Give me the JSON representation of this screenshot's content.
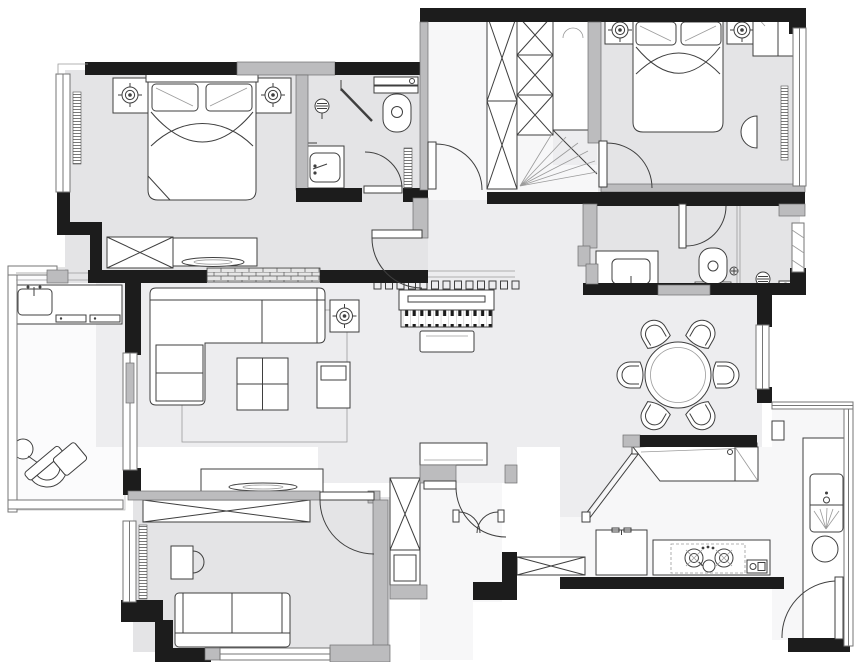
{
  "meta": {
    "title": "apartment-floor-plan",
    "canvas": {
      "width": 860,
      "height": 662
    },
    "drawing_style": "top-down architectural plan, monochrome"
  },
  "palette": {
    "wall": "#1c1c1c",
    "wall_secondary": "#bcbcbe",
    "floor_room": "#e4e4e6",
    "floor_hall": "#ededef",
    "floor_light": "#f7f7f8",
    "balcony": "#fbfbfc",
    "line": "#3f3f3f",
    "line_light": "#9b9b9b",
    "white": "#ffffff"
  },
  "rooms": [
    {
      "id": "bedroom-top-left",
      "fixtures": [
        "double-bed",
        "pillow",
        "pillow",
        "nightstand-with-lamp",
        "nightstand-with-lamp",
        "wardrobe-x",
        "low-cabinet",
        "tv-on-cabinet",
        "window-left",
        "radiator",
        "brick-half-wall",
        "entry-door"
      ]
    },
    {
      "id": "ensuite-bathroom",
      "fixtures": [
        "shower-corner",
        "shower-head",
        "toilet",
        "vanity-sink",
        "radiator",
        "door"
      ]
    },
    {
      "id": "walk-in-closet",
      "fixtures": [
        "wardrobe-column-x",
        "wardrobe-column-x",
        "corner-shelf-fan",
        "cabinet",
        "door"
      ]
    },
    {
      "id": "master-bedroom",
      "fixtures": [
        "double-bed",
        "pillow",
        "pillow",
        "nightstand-with-lamp",
        "nightstand-with-lamp",
        "double-wardrobe",
        "radiator",
        "half-round-shelf",
        "tv-dish",
        "window-right",
        "door-from-closet"
      ]
    },
    {
      "id": "master-bathroom",
      "fixtures": [
        "vanity-sink",
        "toilet",
        "shower-head",
        "floor-drain",
        "glass-partition",
        "frosted-window",
        "sliding-door",
        "toilet-door"
      ]
    },
    {
      "id": "living-room",
      "fixtures": [
        "sectional-sofa",
        "rug",
        "coffee-table",
        "side-table",
        "ceiling-light",
        "tv-cabinet",
        "tv-dish",
        "balcony-sliding-door"
      ]
    },
    {
      "id": "hallway",
      "fixtures": [
        "upright-piano",
        "piano-bench",
        "decorative-screen-squares",
        "tall-cabinet-x",
        "console-cabinet",
        "interior-door"
      ]
    },
    {
      "id": "dining-room",
      "fixtures": [
        "round-table",
        "chair",
        "chair",
        "chair",
        "chair",
        "chair",
        "chair",
        "window-east"
      ]
    },
    {
      "id": "kitchen",
      "fixtures": [
        "bar-counter",
        "refrigerator",
        "counter",
        "gas-hob",
        "kettle",
        "small-appliance",
        "sink",
        "round-basin",
        "diagonal-glass-partition",
        "service-door",
        "glass-wall"
      ]
    },
    {
      "id": "bedroom-bottom-left",
      "fixtures": [
        "wardrobe-x",
        "desk",
        "desk-chair",
        "sofa-bed",
        "window-left",
        "window-bottom",
        "radiator",
        "door"
      ]
    },
    {
      "id": "balcony",
      "fixtures": [
        "laundry-sink",
        "drawer-cabinet",
        "lounge-chair",
        "round-side-table",
        "ottoman",
        "glass-railing",
        "sliding-door"
      ]
    },
    {
      "id": "entry",
      "fixtures": [
        "double-swing-door",
        "shoe-cabinet-x",
        "corridor"
      ]
    }
  ]
}
